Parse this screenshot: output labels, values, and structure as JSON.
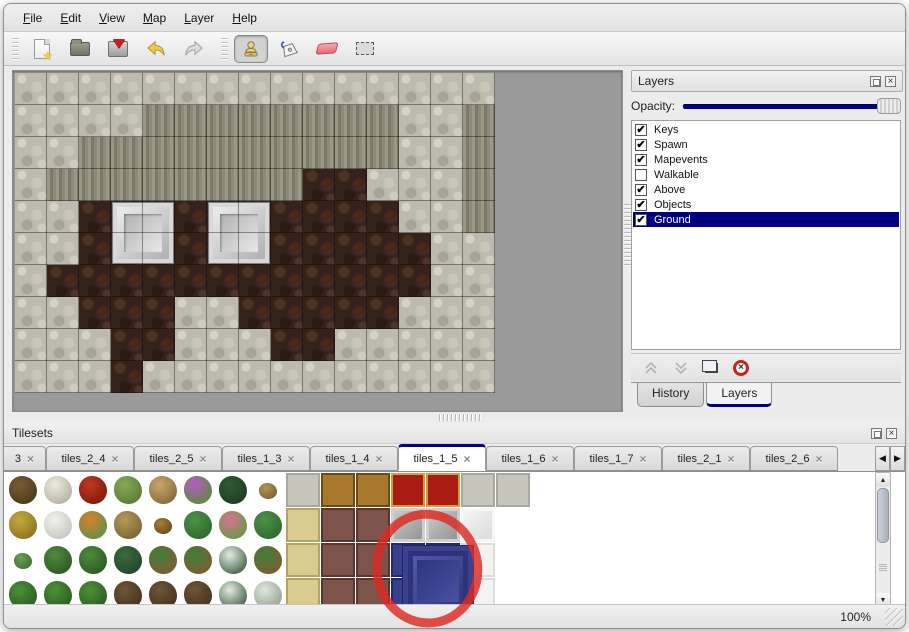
{
  "menu": {
    "items": [
      {
        "label": "File"
      },
      {
        "label": "Edit"
      },
      {
        "label": "View"
      },
      {
        "label": "Map"
      },
      {
        "label": "Layer"
      },
      {
        "label": "Help"
      }
    ]
  },
  "toolbar": {
    "buttons": [
      "new-file",
      "open",
      "save",
      "undo",
      "redo",
      "stamp",
      "fill",
      "eraser",
      "select"
    ],
    "selected": "stamp"
  },
  "layers_panel": {
    "title": "Layers",
    "opacity_label": "Opacity:",
    "layers": [
      {
        "name": "Keys",
        "checked": true,
        "selected": false
      },
      {
        "name": "Spawn",
        "checked": true,
        "selected": false
      },
      {
        "name": "Mapevents",
        "checked": true,
        "selected": false
      },
      {
        "name": "Walkable",
        "checked": false,
        "selected": false
      },
      {
        "name": "Above",
        "checked": true,
        "selected": false
      },
      {
        "name": "Objects",
        "checked": true,
        "selected": false
      },
      {
        "name": "Ground",
        "checked": true,
        "selected": true
      }
    ],
    "tabs": [
      {
        "label": "History",
        "active": false
      },
      {
        "label": "Layers",
        "active": true
      }
    ]
  },
  "tilesets_panel": {
    "title": "Tilesets",
    "tabs": [
      {
        "label": "3",
        "active": false,
        "truncated": true
      },
      {
        "label": "tiles_2_4",
        "active": false
      },
      {
        "label": "tiles_2_5",
        "active": false
      },
      {
        "label": "tiles_1_3",
        "active": false
      },
      {
        "label": "tiles_1_4",
        "active": false
      },
      {
        "label": "tiles_1_5",
        "active": true
      },
      {
        "label": "tiles_1_6",
        "active": false
      },
      {
        "label": "tiles_1_7",
        "active": false
      },
      {
        "label": "tiles_2_1",
        "active": false
      },
      {
        "label": "tiles_2_6",
        "active": false
      }
    ]
  },
  "statusbar": {
    "zoom": "100%"
  },
  "map": {
    "tile_size": 32,
    "grid": [
      "SSSSSSSSSSSSSSS",
      "SSSSCCCCCCCCSSC",
      "SSCCCCCCCCCCSSC",
      "SCCCCCCCCDDSSSC",
      "SSDDDDDDDDDDSSC",
      "SSDDDDDDDDDDDSS",
      "SDDDDDDDDDDDDSS",
      "SSDDDSSDDDDDSSS",
      "SSSDDSSSDDSSSSS",
      "SSSDSSSSSSSSSSS"
    ],
    "doors": [
      {
        "col": 3,
        "row": 4
      },
      {
        "col": 6,
        "row": 4
      }
    ]
  },
  "tileset_grid": {
    "tile_size": 35,
    "rows": [
      [
        "t1",
        "t2",
        "fl",
        "st",
        "tr",
        "pf",
        "fe",
        "wd",
        "SN",
        "TB",
        "TB",
        "RC",
        "RC",
        "SN",
        "SN"
      ],
      [
        "hy",
        "sn",
        "of",
        "dg",
        "lv",
        "lp",
        "pk",
        "lp",
        "KH",
        "MR",
        "MR",
        "SL",
        "SL",
        "WB",
        "w"
      ],
      [
        "sp",
        "bu",
        "bu",
        "bd",
        "pm",
        "pm",
        "py",
        "pm",
        "KH",
        "MR",
        "MR",
        "BL",
        "BL",
        "WC",
        "w"
      ],
      [
        "cn",
        "cn",
        "cn",
        "gn",
        "gn",
        "gn",
        "py",
        "sy",
        "KH",
        "MR",
        "MR",
        "BL",
        "BL",
        "WC",
        "w"
      ]
    ],
    "blue_tile": {
      "col": 11,
      "row": 2,
      "span": 2
    },
    "annotation": {
      "cx": 427,
      "cy": 99,
      "rx": 51,
      "ry": 55,
      "rotation": -8
    }
  },
  "tileset_palette": {
    "t1": {
      "k": "blob",
      "c1": "#7a5c34",
      "c2": "#4f3a1e"
    },
    "t2": {
      "k": "blob",
      "c1": "#eceade",
      "c2": "#b8b4a4"
    },
    "fl": {
      "k": "blob",
      "c1": "#c23a1e",
      "c2": "#7e1c0c"
    },
    "st": {
      "k": "blob",
      "c1": "#86aa52",
      "c2": "#5c7e3a"
    },
    "tr": {
      "k": "blob",
      "c1": "#c9a86a",
      "c2": "#8a6c3e"
    },
    "pf": {
      "k": "blob",
      "c1": "#b45cc2",
      "c2": "#5f8a42"
    },
    "fe": {
      "k": "blob",
      "c1": "#2f5c33",
      "c2": "#1d3d22"
    },
    "wd": {
      "k": "blob-small",
      "c1": "#b39455",
      "c2": "#7e6434"
    },
    "hy": {
      "k": "blob",
      "c1": "#c7a83e",
      "c2": "#8f7524"
    },
    "sn": {
      "k": "blob",
      "c1": "#f2f2ee",
      "c2": "#c9c9c2"
    },
    "of": {
      "k": "blob",
      "c1": "#d97f2e",
      "c2": "#639146"
    },
    "dg": {
      "k": "blob",
      "c1": "#b59a58",
      "c2": "#7c6838"
    },
    "lv": {
      "k": "blob-small",
      "c1": "#a87c3c",
      "c2": "#6f4e22"
    },
    "lp": {
      "k": "blob",
      "c1": "#4d9148",
      "c2": "#2f6b2e"
    },
    "pk": {
      "k": "blob",
      "c1": "#d9738f",
      "c2": "#69984c"
    },
    "sp": {
      "k": "blob-small",
      "c1": "#69a052",
      "c2": "#477236"
    },
    "bu": {
      "k": "blob",
      "c1": "#4f8a3c",
      "c2": "#2f5c26"
    },
    "bd": {
      "k": "blob",
      "c1": "#3c6b3a",
      "c2": "#24472a"
    },
    "pm": {
      "k": "blob",
      "c1": "#3f8038",
      "c2": "#7e5c34"
    },
    "py": {
      "k": "blob",
      "c1": "#e4ebe2",
      "c2": "#4a6a4e"
    },
    "cn": {
      "k": "blob",
      "c1": "#4c9138",
      "c2": "#2c5e22"
    },
    "gn": {
      "k": "blob",
      "c1": "#6f5638",
      "c2": "#463320"
    },
    "sy": {
      "k": "blob",
      "c1": "#dfe7de",
      "c2": "#9aa694"
    },
    "SN": {
      "k": "flat",
      "c1": "#c6c6bc",
      "c2": "#a8a89e"
    },
    "TB": {
      "k": "flat",
      "c1": "#a8782c",
      "c2": "#6e4a16"
    },
    "RC": {
      "k": "flat",
      "c1": "#a81c14",
      "c2": "#d09c3c"
    },
    "KH": {
      "k": "flat",
      "c1": "#d9cc8e",
      "c2": "#b5a360"
    },
    "MR": {
      "k": "flat",
      "c1": "#7c544c",
      "c2": "#553630"
    },
    "SL": {
      "k": "bevel",
      "c1": "#cfcfcf",
      "c2": "#8f8f8f"
    },
    "WB": {
      "k": "bevel",
      "c1": "#f7f7f7",
      "c2": "#d9d9d9"
    },
    "WC": {
      "k": "flat",
      "c1": "#f3f3f1",
      "c2": "#ddddd8"
    },
    "BL": {
      "k": "flat",
      "c1": "#3a3f8c",
      "c2": "#23276b"
    },
    "w": {
      "k": "flat",
      "c1": "#ffffff",
      "c2": "#ffffff"
    }
  },
  "colors": {
    "accent_navy": "#000080",
    "slider_fill": "#00008b",
    "annotation_red": "#dd2a22",
    "map_scale_rock": "#bdbaae",
    "map_cliff": "#8d8a7a",
    "map_dirt": "#35221a",
    "delete_red": "#cc1f1f"
  }
}
